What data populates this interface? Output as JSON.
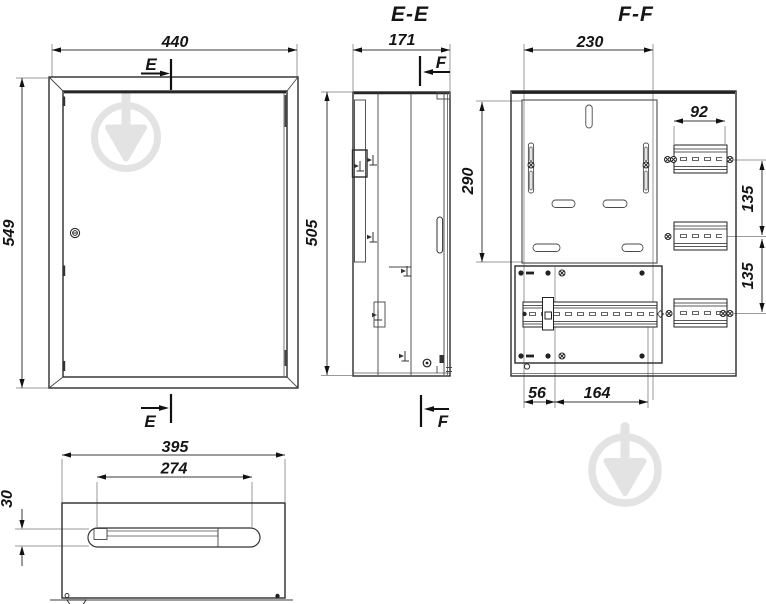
{
  "drawing": {
    "type": "technical-drawing-electrical-meter-cabinet",
    "sections": {
      "ee": {
        "title": "E-E"
      },
      "ff": {
        "title": "F-F"
      }
    },
    "front": {
      "cut_letter": "E",
      "dim_width": "440",
      "dim_height": "549"
    },
    "ee": {
      "cut_letter": "F",
      "dim_width": "171",
      "dim_height": "505"
    },
    "ff": {
      "dim_plate_width": "230",
      "dim_plate_height": "290",
      "dim_rail_width": "92",
      "dim_spacing_upper": "135",
      "dim_spacing_lower": "135",
      "dim_offset": "56",
      "dim_rail_length": "164"
    },
    "bottom": {
      "dim_width": "395",
      "dim_slot_width": "274",
      "dim_slot_height": "30"
    },
    "colors": {
      "line": "#2b2b2b",
      "dimension": "#3a3a3a",
      "extension": "#9a9a9a",
      "watermark": "#e3e3e3",
      "background": "#ffffff"
    },
    "watermark_icon": "circle-down-arrow-watermark"
  }
}
